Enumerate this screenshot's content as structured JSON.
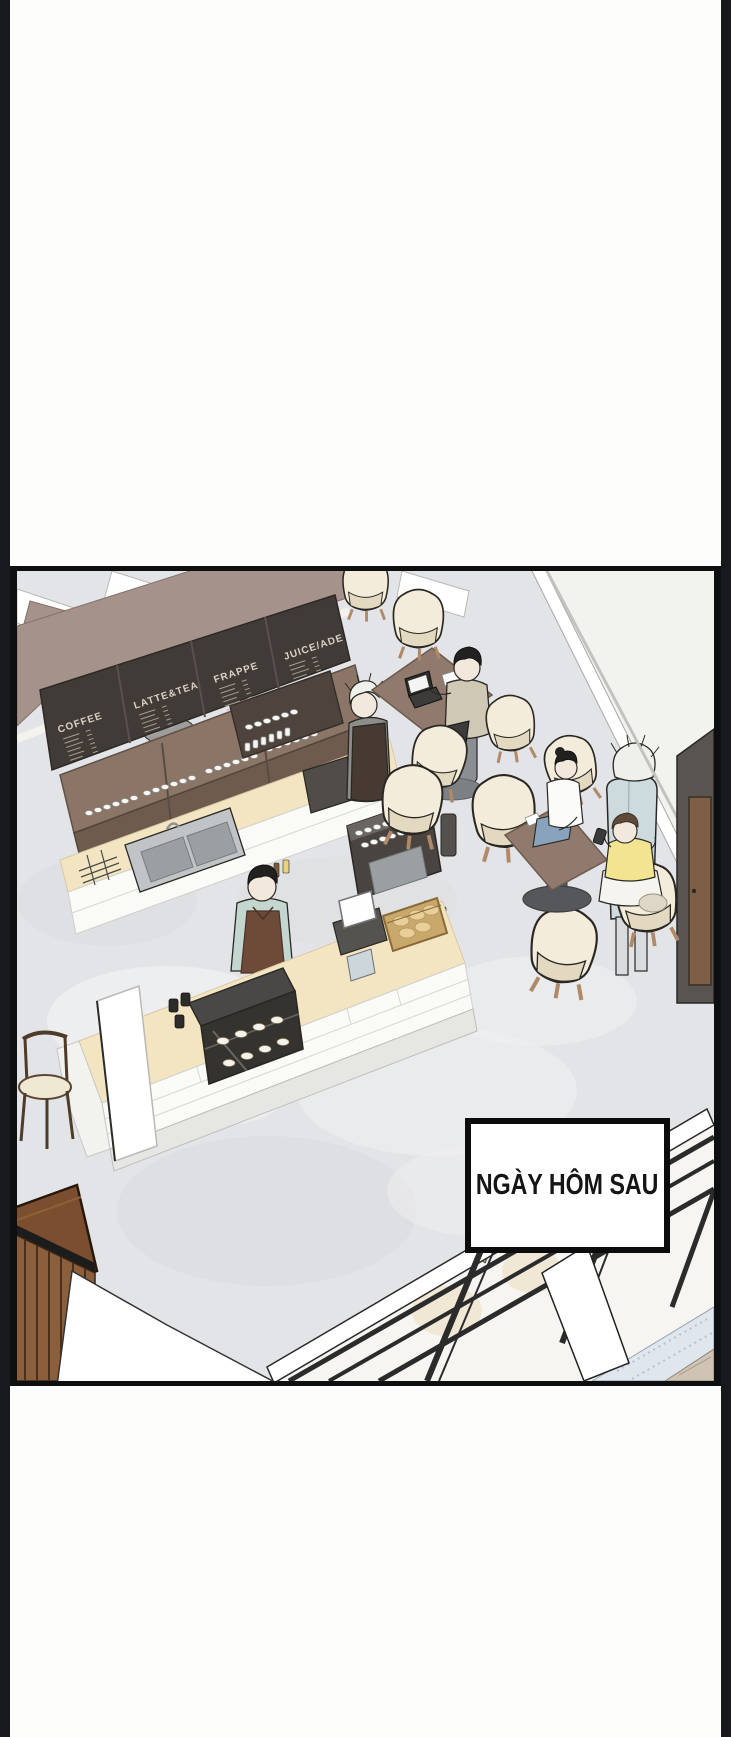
{
  "caption": "NGÀY HÔM SAU",
  "menu_boards": [
    {
      "title": "COFFEE"
    },
    {
      "title": "LATTE&TEA"
    },
    {
      "title": "FRAPPE"
    },
    {
      "title": "JUICE/ADE"
    }
  ],
  "colors": {
    "ink": "#2a2723",
    "floor": "#e3e4e7",
    "floor_light": "#eff0f2",
    "floor_dark": "#d7d9dc",
    "exterior": "#f2f2ef",
    "taupe": "#a5928a",
    "taupe_dark": "#84726a",
    "board": "#413b37",
    "board_text": "#d9d2c6",
    "shelf": "#8a7566",
    "shelf_dark": "#6e5b4e",
    "cream": "#f4e5c2",
    "tile": "#fafaf7",
    "tile_line": "#d6d6d2",
    "steel": "#c0c4c6",
    "steel_dark": "#9aa0a2",
    "machine": "#49443f",
    "apron": "#6e4a38",
    "apron_dark": "#473a32",
    "shirt": "#c3d6cf",
    "chair": "#f3ecda",
    "chair_shadow": "#e3d9c1",
    "wood_leg": "#b08968",
    "walnut": "#7a4e2e",
    "slat": "#8b5e3c",
    "jeans": "#8aa3bd",
    "yellow": "#f2e491",
    "skirt": "#f6f4ef",
    "coat": "#cddade",
    "door": "#58544f",
    "door_wood": "#7d5f46",
    "mullion": "#2b2b2b",
    "sill": "#dfe6ee",
    "paver": "#cfc4b4",
    "orange": "#e08a2e",
    "hair_dark": "#23211f",
    "hair_white": "#efefec",
    "skin": "#f3e8dc"
  }
}
